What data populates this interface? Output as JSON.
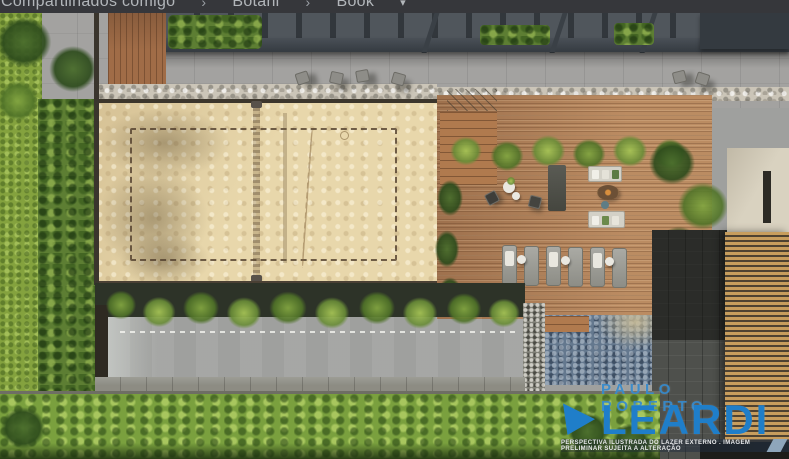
{
  "header": {
    "breadcrumb": [
      {
        "label": "Compartilhados comigo"
      },
      {
        "label": "Botani"
      },
      {
        "label": "Book"
      }
    ],
    "separator": "›",
    "dropdown_arrow": "▾"
  },
  "watermark": {
    "line1": "PAULO ROBERTO",
    "line2": "LEARDI",
    "caption": "PERSPECTIVA ILUSTRADA DO LAZER EXTERNO . IMAGEM PRELIMINAR SUJEITA A ALTERAÇÃO",
    "brand_color": "#1f7ec9"
  },
  "scene": {
    "kind": "aerial architectural rendering of a residential leisure deck",
    "features": [
      "sand sports court",
      "lap pool",
      "stone plunge pool",
      "wood deck",
      "sun loungers",
      "lounge sofas with fire pit",
      "pergola",
      "gardens and hedges",
      "slatted wood facade"
    ],
    "colors": {
      "sand": "#e8d7ab",
      "lap_pool_water": "#8fc0c4",
      "plunge_pool": "#64788e",
      "deck_wood": "#b2815a",
      "vegetation": "#6f9440",
      "pergola": "#41474d",
      "wood_louvers": "#c79d5d",
      "topbar": "#36373b"
    }
  }
}
